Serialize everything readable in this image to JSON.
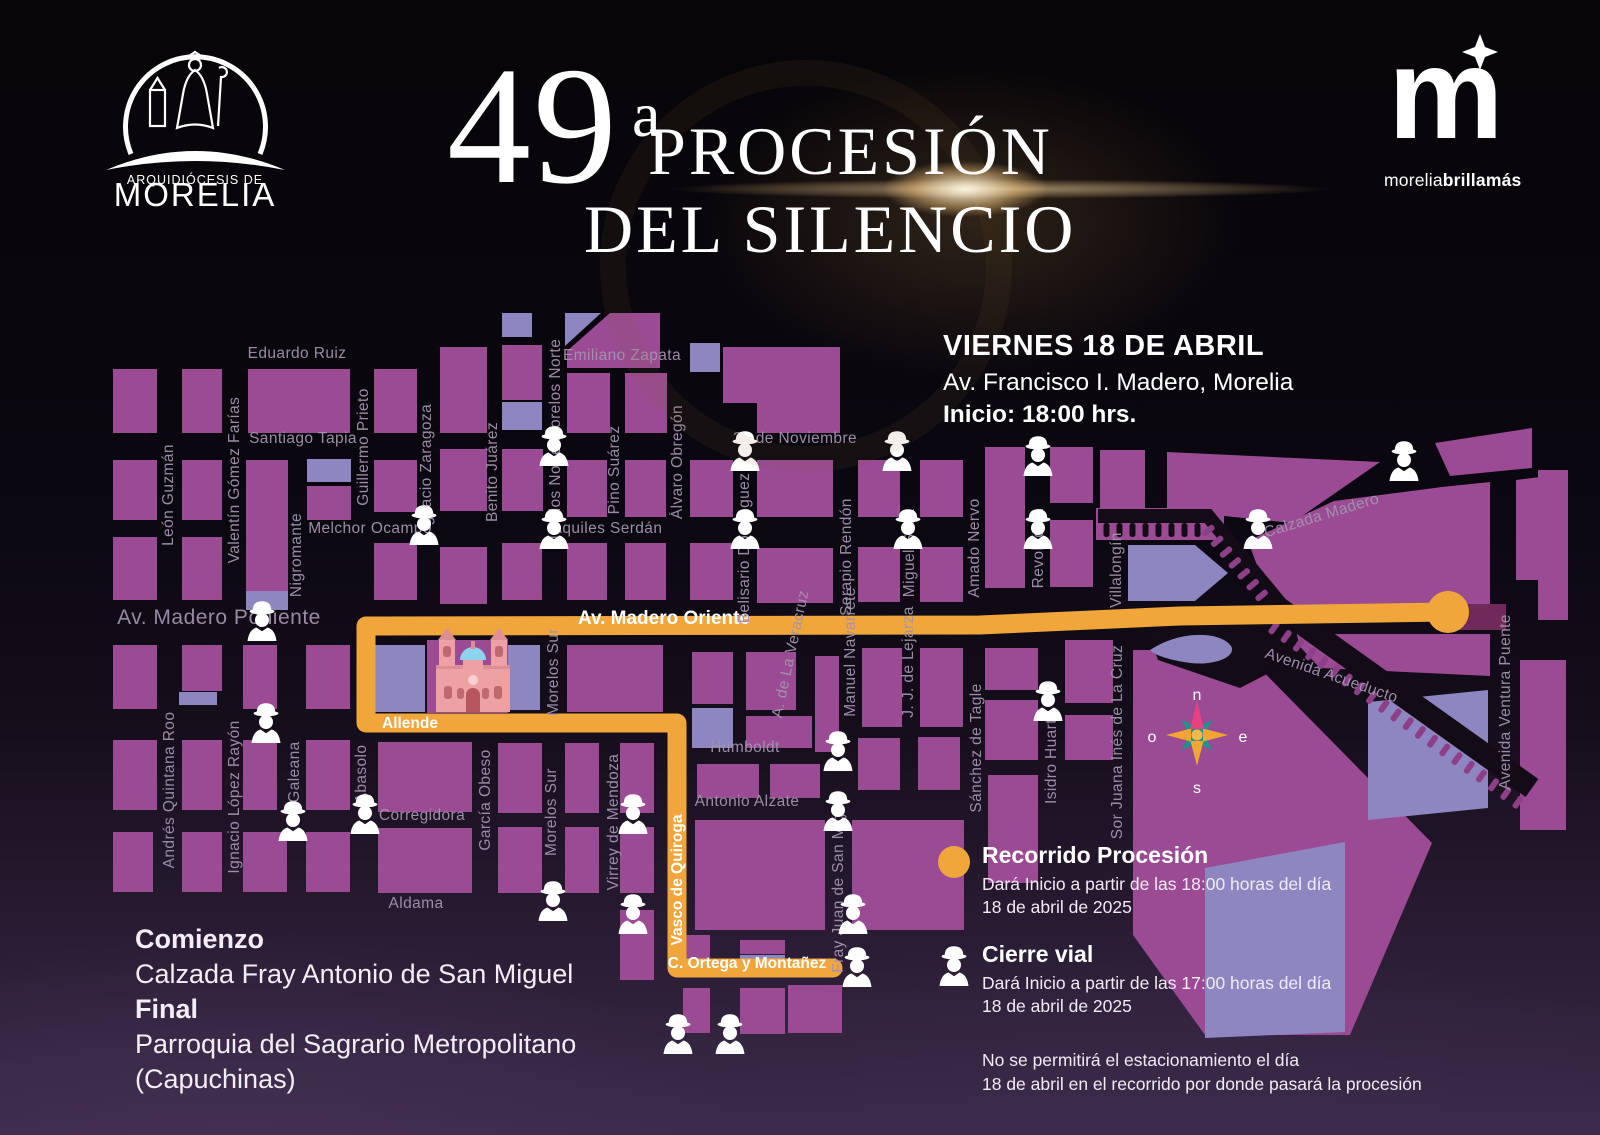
{
  "header": {
    "archdiocese_line1": "ARQUIDIÓCESIS DE",
    "archdiocese_line2": "MORELIA",
    "title_number": "49",
    "title_ordinal": "a",
    "title_line1": "PROCESIÓN",
    "title_line2": "DEL SILENCIO",
    "brand_m": "m",
    "brand_tagline_1": "morelia",
    "brand_tagline_2": "brilla",
    "brand_tagline_3": "más"
  },
  "event": {
    "line1": "VIERNES 18 DE ABRIL",
    "line2": "Av. Francisco I. Madero, Morelia",
    "line3": "Inicio: 18:00 hrs."
  },
  "route_info": {
    "start_label": "Comienzo",
    "start_value": "Calzada Fray Antonio de San Miguel",
    "end_label": "Final",
    "end_value_1": "Parroquia del Sagrario Metropolitano",
    "end_value_2": "(Capuchinas)"
  },
  "legend": {
    "route": {
      "title": "Recorrido Procesión",
      "desc1": "Dará Inicio a partir de las 18:00 horas del día",
      "desc2": "18 de abril de 2025"
    },
    "closure": {
      "title": "Cierre vial",
      "desc1": "Dará Inicio a partir de las 17:00 horas del día",
      "desc2": "18 de abril de 2025"
    },
    "note1": "No se permitirá el estacionamiento el día",
    "note2": "18 de abril en el recorrido por donde pasará la procesión"
  },
  "map": {
    "compass": {
      "n": "n",
      "s": "s",
      "e": "e",
      "o": "o"
    },
    "streets": {
      "eduardo_ruiz": "Eduardo Ruiz",
      "santiago_tapia": "Santiago Tapia",
      "melchor_ocampo": "Melchor Ocampo",
      "emiliano_zapata": "Emiliano Zapata",
      "aquiles_serdan": "Aquiles Serdán",
      "veinte_de_noviembre": "20 de Noviembre",
      "humboldt": "Humboldt",
      "antonio_alzate": "Antonio Alzate",
      "corregidora": "Corregidora",
      "aldama": "Aldama",
      "av_madero_poniente": "Av. Madero Poniente",
      "av_madero_oriente": "Av. Madero Oriente",
      "allende": "Allende",
      "vasco_de_quiroga": "Vasco de Quiroga",
      "c_ortega": "C. Ortega y Montañez",
      "calzada_madero": "Calzada Madero",
      "avenida_acueducto": "Avenida Acueducto",
      "leon_guzman": "León Guzmán",
      "valentin_gomez_farias": "Valentín Gómez Farías",
      "nigromante": "Nigromante",
      "guillermo_prieto": "Guillermo Prieto",
      "ignacio_zaragoza": "Ignacio Zaragoza",
      "benito_juarez": "Benito Juárez",
      "morelos_norte": "Morelos Norte",
      "pino_suarez": "Pino Suárez",
      "alvaro_obregon": "Álvaro Obregón",
      "belisario_dominguez": "Belisario Domínguez",
      "serapio_rendon": "Serapio Rendón",
      "miguel_silva": "Miguel Silva",
      "amado_nervo": "Amado Nervo",
      "revolucion": "Revolución",
      "villalongin": "Villalongín",
      "sor_juana": "Sor Juana Inés de La Cruz",
      "isidro_huarte": "Isidro Huarte",
      "sanchez_de_tagle": "Sánchez de Tagle",
      "ventura_puente": "Avenida Ventura Puente",
      "andres_quintana_roo": "Andrés Quintana Roo",
      "ignacio_lopez_rayon": "Ignacio López Rayón",
      "galeana": "Galeana",
      "abasolo": "Abasolo",
      "garcia_obeso": "García Obeso",
      "morelos_sur": "Morelos Sur",
      "virrey_de_mendoza": "Virrey de Mendoza",
      "fray_juan": "Fray Juan de San Miguel",
      "a_de_la_veracruz": "A. de La Veracruz",
      "manuel_navarrete": "Manuel Navarrete",
      "jj_de_lejarza": "J. J. de Lejarza"
    },
    "police_positions": [
      [
        554,
        445
      ],
      [
        745,
        450
      ],
      [
        897,
        450
      ],
      [
        1038,
        455
      ],
      [
        1404,
        460
      ],
      [
        424,
        524
      ],
      [
        554,
        528
      ],
      [
        745,
        528
      ],
      [
        908,
        528
      ],
      [
        1038,
        528
      ],
      [
        1258,
        528
      ],
      [
        262,
        620
      ],
      [
        266,
        722
      ],
      [
        293,
        820
      ],
      [
        365,
        813
      ],
      [
        633,
        813
      ],
      [
        553,
        900
      ],
      [
        633,
        913
      ],
      [
        838,
        750
      ],
      [
        838,
        810
      ],
      [
        853,
        913
      ],
      [
        857,
        966
      ],
      [
        1048,
        700
      ],
      [
        678,
        1033
      ],
      [
        730,
        1033
      ]
    ]
  },
  "colors": {
    "route": "#f0a63b",
    "block": "#9a4b94",
    "block_light": "#8e86c1",
    "aqueduct_arches": "#8d3f88",
    "background_dark": "#130c16"
  }
}
